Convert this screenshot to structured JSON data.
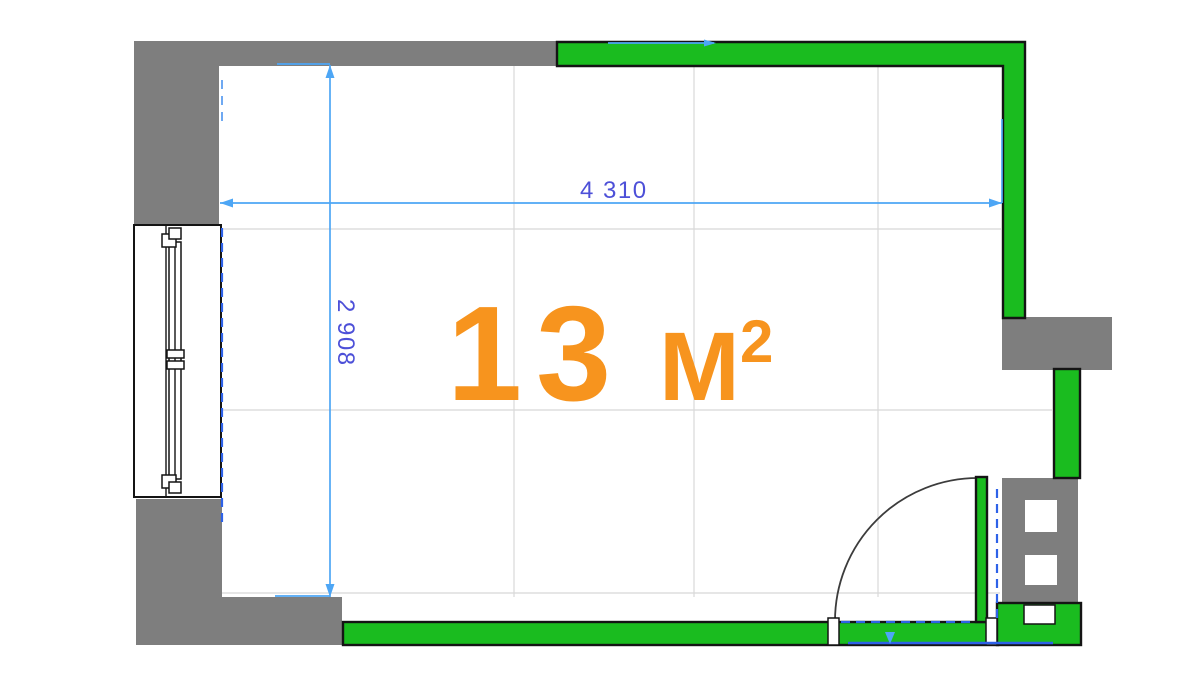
{
  "area_label": {
    "value": "13",
    "unit": "м",
    "sup": "2"
  },
  "dimensions": {
    "width_label": "4 310",
    "height_label": "2 908"
  },
  "colors": {
    "wall_green": "#1abc1f",
    "wall_gray": "#7e7e7e",
    "area_text": "#f7941e",
    "dim_line": "#4da6f5",
    "dim_text": "#4d50d8",
    "door_dash": "#2e62e8",
    "grid": "#d8d8d8",
    "outline": "#141414"
  }
}
